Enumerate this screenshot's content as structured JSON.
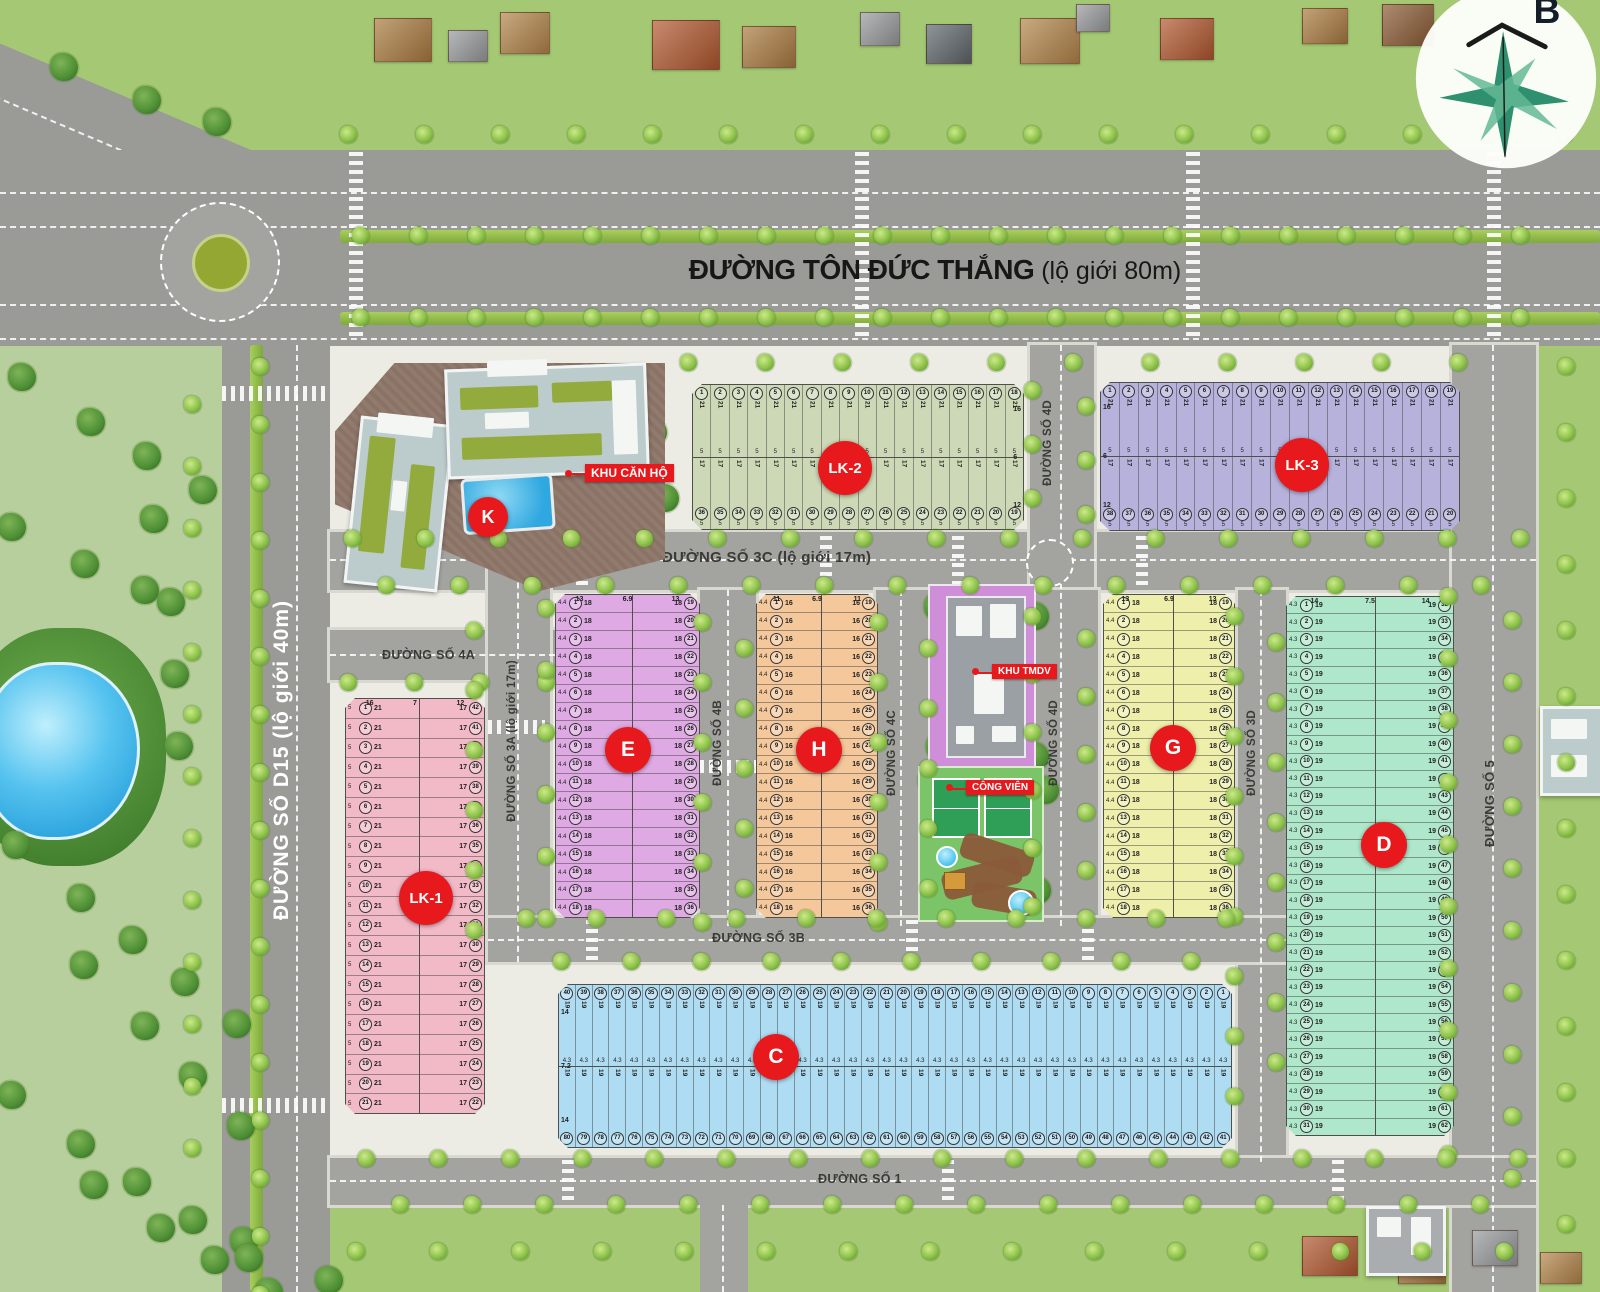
{
  "compass": {
    "label": "B"
  },
  "roads": {
    "ton_duc_thang": {
      "name": "ĐƯỜNG TÔN ĐỨC THẮNG",
      "suffix": " (lộ giới 80m)"
    },
    "d15": {
      "name": "ĐƯỜNG SỐ D15 (lộ giới 40m)"
    },
    "r3c": {
      "name": "ĐƯỜNG SỐ 3C (lộ giới 17m)"
    },
    "r4a": {
      "name": "ĐƯỜNG SỐ 4A"
    },
    "r3a": {
      "name": "ĐƯỜNG SỐ 3A (lộ giới 17m)"
    },
    "r4b": {
      "name": "ĐƯỜNG SỐ 4B"
    },
    "r4c": {
      "name": "ĐƯỜNG SỐ 4C"
    },
    "r4d": {
      "name": "ĐƯỜNG SỐ 4D"
    },
    "r3d": {
      "name": "ĐƯỜNG SỐ 3D"
    },
    "r5": {
      "name": "ĐƯỜNG SỐ 5"
    },
    "r3b": {
      "name": "ĐƯỜNG SỐ 3B"
    },
    "r1": {
      "name": "ĐƯỜNG SỐ 1"
    }
  },
  "zones": {
    "khu_can_ho": {
      "badge": "K",
      "label": "KHU CĂN HỘ"
    },
    "khu_tmdv": {
      "label": "KHU TMDV"
    },
    "cong_vien": {
      "label": "CÔNG VIÊN"
    }
  },
  "blocks": {
    "lk1": {
      "badge": "LK-1",
      "fill": "#f2b9c7",
      "layout": "h",
      "cols": [
        {
          "from": 1,
          "to": 21,
          "depth": "21",
          "width": "5"
        },
        {
          "from": 42,
          "to": 22,
          "depth": "17",
          "width": ""
        }
      ],
      "top_dims": [
        "16",
        "7",
        "12"
      ]
    },
    "lk2": {
      "badge": "LK-2",
      "fill": "#ccd8b6",
      "layout": "v",
      "rows": [
        {
          "from": 1,
          "to": 18,
          "depth": "21",
          "width": "5"
        },
        {
          "from": 36,
          "to": 19,
          "depth": "17",
          "width": "5"
        }
      ],
      "side_dims": [
        "16",
        "6",
        "12"
      ],
      "side": "right"
    },
    "lk3": {
      "badge": "LK-3",
      "fill": "#b6b2dc",
      "layout": "v",
      "rows": [
        {
          "from": 1,
          "to": 19,
          "depth": "21",
          "width": "5"
        },
        {
          "from": 38,
          "to": 20,
          "depth": "17",
          "width": "5"
        }
      ],
      "side_dims": [
        "16",
        "6",
        "12"
      ],
      "side": "left"
    },
    "e": {
      "badge": "E",
      "fill": "#dfa9e3",
      "layout": "h",
      "cols": [
        {
          "from": 1,
          "to": 18,
          "depth": "18",
          "width": "4.4"
        },
        {
          "from": 19,
          "to": 36,
          "depth": "18",
          "width": ""
        }
      ],
      "top_dims": [
        "13",
        "6.9",
        "13"
      ]
    },
    "h": {
      "badge": "H",
      "fill": "#f4c89b",
      "layout": "h",
      "cols": [
        {
          "from": 1,
          "to": 18,
          "depth": "16",
          "width": "4.4"
        },
        {
          "from": 19,
          "to": 36,
          "depth": "16",
          "width": ""
        }
      ],
      "top_dims": [
        "11",
        "6.9",
        "11"
      ]
    },
    "g": {
      "badge": "G",
      "fill": "#edefab",
      "layout": "h",
      "cols": [
        {
          "from": 1,
          "to": 18,
          "depth": "18",
          "width": "4.4"
        },
        {
          "from": 19,
          "to": 36,
          "depth": "18",
          "width": ""
        }
      ],
      "top_dims": [
        "13",
        "6.9",
        "13"
      ]
    },
    "d": {
      "badge": "D",
      "fill": "#afe7cb",
      "layout": "h",
      "cols": [
        {
          "from": 1,
          "to": 31,
          "depth": "19",
          "width": "4.3"
        },
        {
          "from": 32,
          "to": 62,
          "depth": "19",
          "width": ""
        }
      ],
      "top_dims": [
        "14",
        "7.5",
        "14"
      ]
    },
    "c": {
      "badge": "C",
      "fill": "#aedcf2",
      "layout": "v",
      "rows": [
        {
          "from": 40,
          "to": 1,
          "depth": "19",
          "width": "4.3"
        },
        {
          "from": 80,
          "to": 41,
          "depth": "19",
          "width": ""
        }
      ],
      "side_dims": [
        "14",
        "7.2",
        "14"
      ],
      "side": "left"
    }
  },
  "decor": {
    "tree_strips": [
      [
        340,
        126,
        76,
        0,
        17,
        "s"
      ],
      [
        352,
        227,
        58,
        0,
        21,
        "s"
      ],
      [
        352,
        309,
        58,
        0,
        21,
        "s"
      ],
      [
        680,
        354,
        77,
        0,
        11,
        "s"
      ],
      [
        252,
        358,
        0,
        58,
        17,
        "s"
      ],
      [
        184,
        396,
        0,
        62,
        13,
        "s"
      ],
      [
        344,
        530,
        73,
        0,
        17,
        "s"
      ],
      [
        378,
        577,
        73,
        0,
        16,
        "s"
      ],
      [
        340,
        674,
        66,
        0,
        4,
        "s"
      ],
      [
        466,
        622,
        0,
        60,
        6,
        "s"
      ],
      [
        538,
        600,
        0,
        62,
        6,
        "s"
      ],
      [
        694,
        614,
        0,
        60,
        6,
        "s"
      ],
      [
        736,
        640,
        0,
        60,
        5,
        "s"
      ],
      [
        870,
        614,
        0,
        60,
        6,
        "s"
      ],
      [
        920,
        640,
        0,
        60,
        5,
        "s"
      ],
      [
        1024,
        382,
        0,
        54,
        3,
        "s"
      ],
      [
        1078,
        398,
        0,
        54,
        3,
        "s"
      ],
      [
        1024,
        608,
        0,
        58,
        6,
        "s"
      ],
      [
        1078,
        630,
        0,
        58,
        5,
        "s"
      ],
      [
        1226,
        608,
        0,
        60,
        9,
        "s"
      ],
      [
        1268,
        634,
        0,
        60,
        8,
        "s"
      ],
      [
        1440,
        588,
        0,
        62,
        10,
        "s"
      ],
      [
        1504,
        612,
        0,
        62,
        10,
        "s"
      ],
      [
        518,
        910,
        70,
        0,
        11,
        "s"
      ],
      [
        553,
        953,
        70,
        0,
        10,
        "s"
      ],
      [
        358,
        1150,
        72,
        0,
        17,
        "s"
      ],
      [
        392,
        1196,
        72,
        0,
        16,
        "s"
      ],
      [
        1558,
        358,
        0,
        66,
        14,
        "s"
      ],
      [
        348,
        1243,
        82,
        0,
        15,
        "s"
      ],
      [
        236,
        1232,
        74,
        30,
        4,
        "p"
      ],
      [
        14,
        368,
        58,
        36,
        4,
        "p"
      ],
      [
        4,
        518,
        62,
        28,
        3,
        "p"
      ],
      [
        146,
        510,
        6,
        74,
        4,
        "p"
      ],
      [
        8,
        836,
        54,
        44,
        5,
        "p"
      ],
      [
        76,
        956,
        50,
        52,
        4,
        "p"
      ],
      [
        4,
        1086,
        58,
        40,
        5,
        "p"
      ],
      [
        86,
        1176,
        56,
        34,
        4,
        "p"
      ],
      [
        56,
        58,
        72,
        24,
        3,
        "p"
      ],
      [
        592,
        386,
        42,
        28,
        2,
        "p"
      ],
      [
        606,
        474,
        40,
        6,
        2,
        "p"
      ],
      [
        930,
        598,
        86,
        0,
        2,
        "p"
      ],
      [
        932,
        738,
        84,
        0,
        2,
        "p"
      ],
      [
        924,
        772,
        102,
        0,
        2,
        "p"
      ],
      [
        1014,
        816,
        4,
        56,
        2,
        "p"
      ],
      [
        926,
        876,
        8,
        0,
        1,
        "p"
      ]
    ],
    "houses": [
      [
        374,
        18,
        56,
        42,
        "#a97a3f"
      ],
      [
        448,
        30,
        38,
        30,
        "#97999b"
      ],
      [
        500,
        12,
        48,
        40,
        "#b28449"
      ],
      [
        652,
        20,
        66,
        48,
        "#b0572e"
      ],
      [
        742,
        26,
        52,
        40,
        "#a97a3f"
      ],
      [
        860,
        12,
        38,
        32,
        "#97999b"
      ],
      [
        926,
        24,
        44,
        38,
        "#5e666b"
      ],
      [
        1020,
        18,
        58,
        44,
        "#b28449"
      ],
      [
        1076,
        4,
        32,
        26,
        "#97999b"
      ],
      [
        1160,
        18,
        52,
        40,
        "#b0572e"
      ],
      [
        1302,
        8,
        44,
        34,
        "#a97a3f"
      ],
      [
        1382,
        4,
        50,
        40,
        "#8a5a33"
      ],
      [
        1302,
        1236,
        54,
        38,
        "#b0572e"
      ],
      [
        1398,
        1248,
        46,
        34,
        "#a97a3f"
      ],
      [
        1472,
        1230,
        44,
        34,
        "#97999b"
      ],
      [
        1540,
        1252,
        40,
        30,
        "#b28449"
      ]
    ],
    "crosswalks": [
      [
        349,
        152,
        14,
        188,
        "h"
      ],
      [
        855,
        152,
        14,
        188,
        "h"
      ],
      [
        1186,
        152,
        14,
        188,
        "h"
      ],
      [
        1487,
        152,
        14,
        188,
        "h"
      ],
      [
        222,
        386,
        108,
        15,
        "v"
      ],
      [
        222,
        1098,
        108,
        15,
        "v"
      ],
      [
        576,
        536,
        12,
        50,
        "h"
      ],
      [
        820,
        536,
        12,
        50,
        "h"
      ],
      [
        952,
        536,
        12,
        50,
        "h"
      ],
      [
        1136,
        536,
        12,
        50,
        "h"
      ],
      [
        586,
        920,
        12,
        42,
        "h"
      ],
      [
        906,
        920,
        12,
        42,
        "h"
      ],
      [
        1082,
        920,
        12,
        42,
        "h"
      ],
      [
        562,
        1160,
        12,
        45,
        "h"
      ],
      [
        942,
        1160,
        12,
        45,
        "h"
      ],
      [
        1332,
        1160,
        12,
        45,
        "h"
      ],
      [
        488,
        720,
        57,
        14,
        "v"
      ],
      [
        700,
        760,
        56,
        13,
        "v"
      ]
    ]
  },
  "colors": {
    "badge_red": "#e8191c",
    "road_gray": "#a3a3a0",
    "grass_green": "#a4c873",
    "water_blue": "#2fa7e0"
  }
}
